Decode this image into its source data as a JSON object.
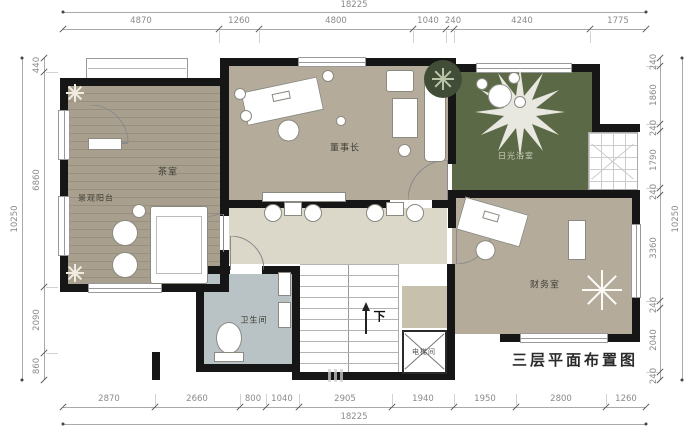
{
  "title": "三层平面布置图",
  "rooms": {
    "tea_room": "茶室",
    "balcony": "景观阳台",
    "chairman": "董事长",
    "sunroom": "日光浴室",
    "finance": "财务室",
    "bathroom": "卫生间",
    "elevator": "电梯间",
    "stairs_direction": "下"
  },
  "dimensions": {
    "top_total": "18225",
    "top_segments": [
      "4870",
      "1260",
      "4800",
      "1040",
      "240",
      "4240",
      "1775"
    ],
    "bottom_segments": [
      "2870",
      "2660",
      "800",
      "1040",
      "2905",
      "1940",
      "1950",
      "2800",
      "1260"
    ],
    "bottom_total": "18225",
    "left_total": "10250",
    "left_segments": [
      "440",
      "6860",
      "2090",
      "860"
    ],
    "right_segments": [
      "240",
      "1860",
      "240",
      "1790",
      "240",
      "3360",
      "240",
      "2040",
      "240"
    ],
    "right_total": "10250"
  },
  "colors": {
    "wall": "#161616",
    "wood_floor": "#a89f8e",
    "office_floor": "#b4ab9b",
    "sunroom_floor": "#5b6946",
    "corridor_floor": "#dbd7c9",
    "bathroom_floor": "#b9c3c6",
    "dimension_text": "#8a8a8a"
  }
}
